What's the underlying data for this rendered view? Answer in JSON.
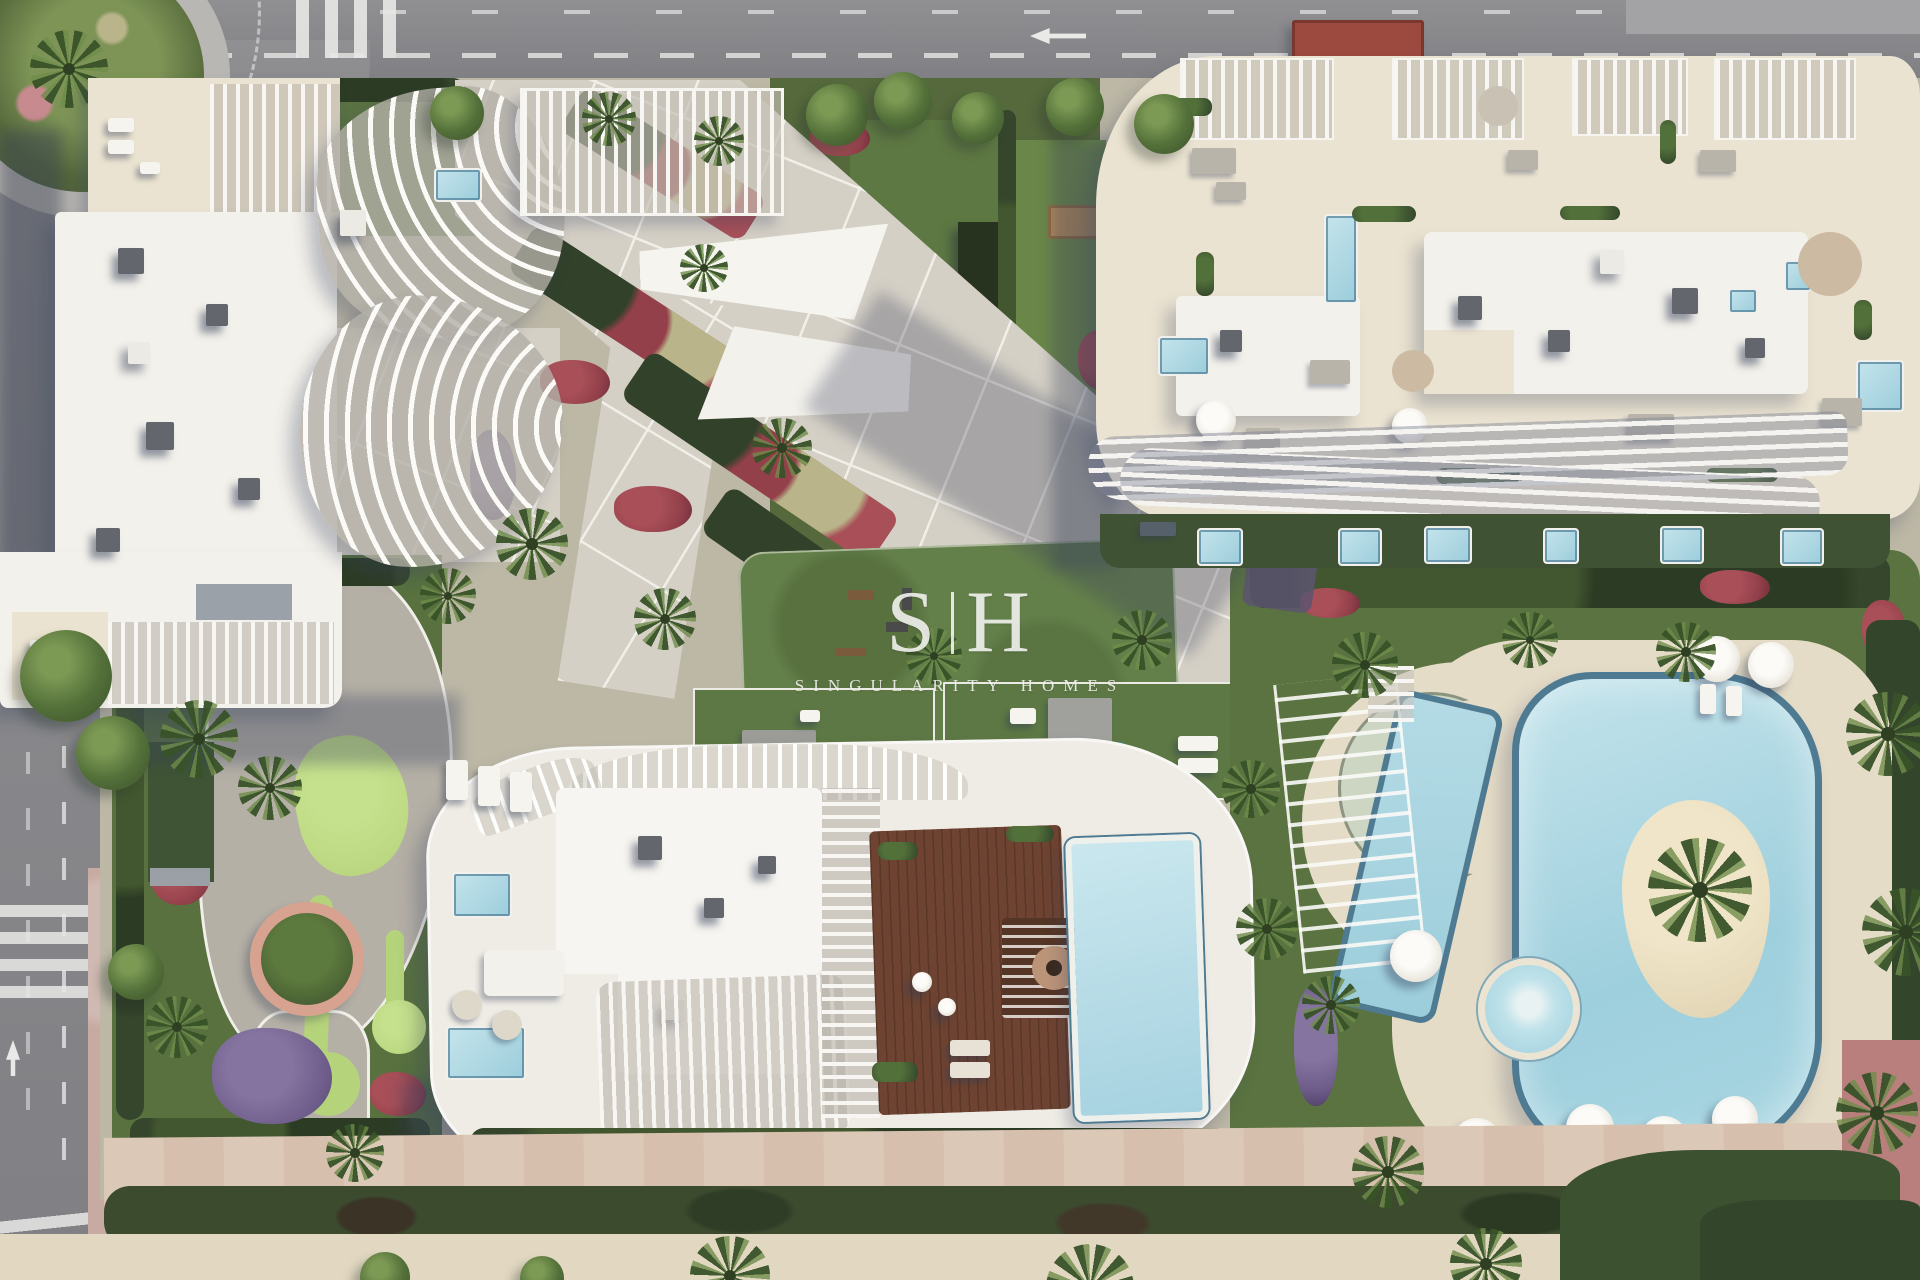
{
  "watermark": {
    "monogram_left": "S",
    "monogram_divider": "|",
    "monogram_right": "H",
    "wordmark": "SINGULARITY HOMES"
  },
  "colors": {
    "road": "#8d8d90",
    "paving": "#d5d0c6",
    "pavingLine": "#f2efe9",
    "lawn": "#5f7a44",
    "lawnBright": "#6a8749",
    "puttingGreen": "#b5d37b",
    "hedge": "#35462c",
    "roofWhite": "#f3f1eb",
    "terraceCream": "#ebe3d1",
    "acGray": "#63666d",
    "poolWater": "#aed8e3",
    "poolRim": "#4e7a92",
    "sand": "#e8dec1",
    "deckWood": "#6e4331",
    "pinkPath": "#d6c0ad",
    "pinkSidewalk": "#c7aaa2",
    "redFlower": "#93404b",
    "purpleFlower": "#6c5a88",
    "bottomSand": "#e2d8c2",
    "kioskRed": "#9c4a40",
    "redPavement": "#b97f7d",
    "crescentWater": "#ccd6c3",
    "shadow": "rgba(55,65,95,0.33)",
    "watermark": "rgba(250,250,248,0.85)"
  }
}
